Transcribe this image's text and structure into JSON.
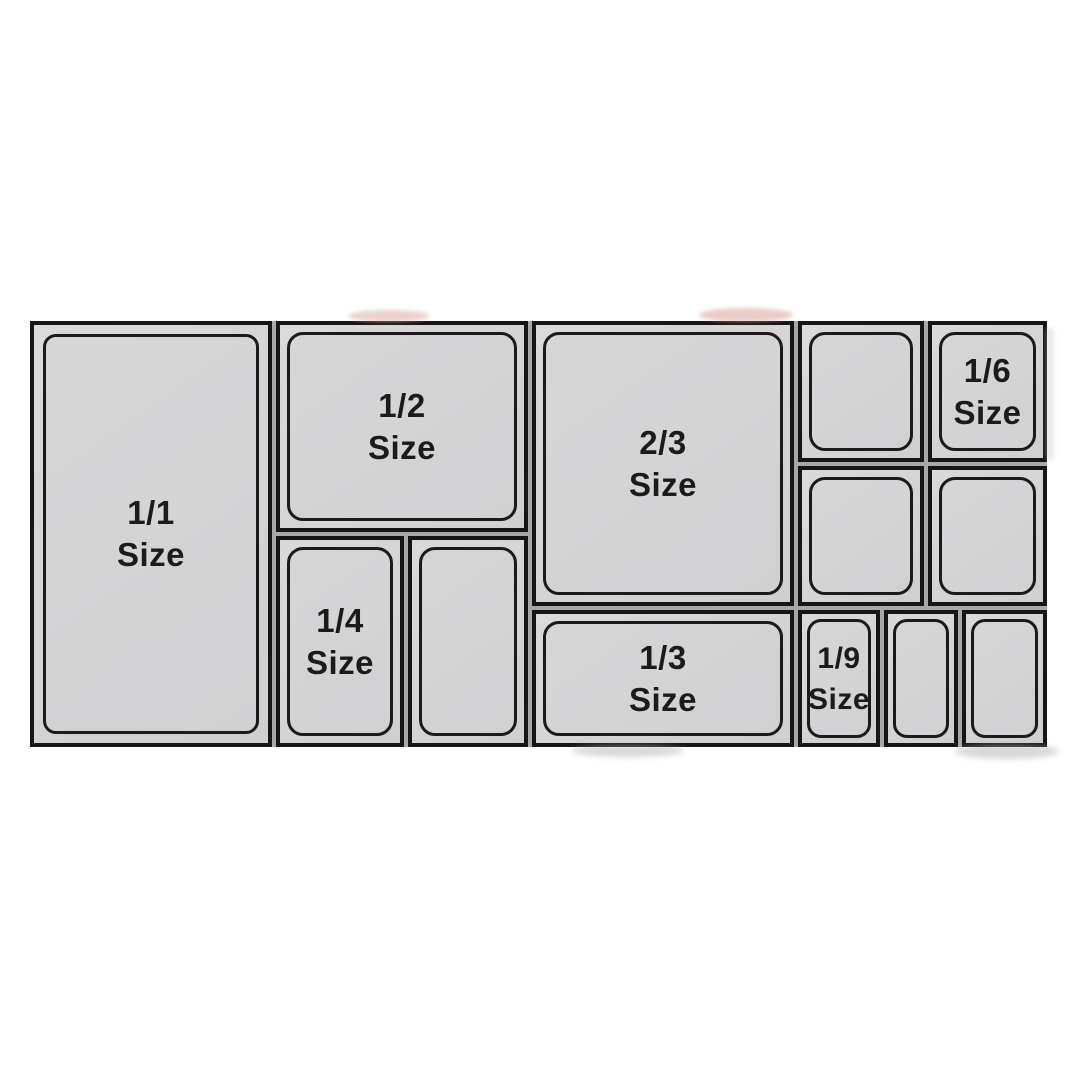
{
  "title": "Gastronorm pan size layout chart",
  "colors": {
    "background": "#ffffff",
    "pan_fill": "#d4d4d5",
    "pan_outline": "#161616",
    "label_text": "#1b1b1b"
  },
  "pans": {
    "full": {
      "line1": "1/1",
      "line2": "Size"
    },
    "half": {
      "line1": "1/2",
      "line2": "Size"
    },
    "two_thirds": {
      "line1": "2/3",
      "line2": "Size"
    },
    "third": {
      "line1": "1/3",
      "line2": "Size"
    },
    "quarter": {
      "line1": "1/4",
      "line2": "Size"
    },
    "sixth": {
      "line1": "1/6",
      "line2": "Size"
    },
    "ninth": {
      "line1": "1/9",
      "line2": "Size"
    }
  }
}
